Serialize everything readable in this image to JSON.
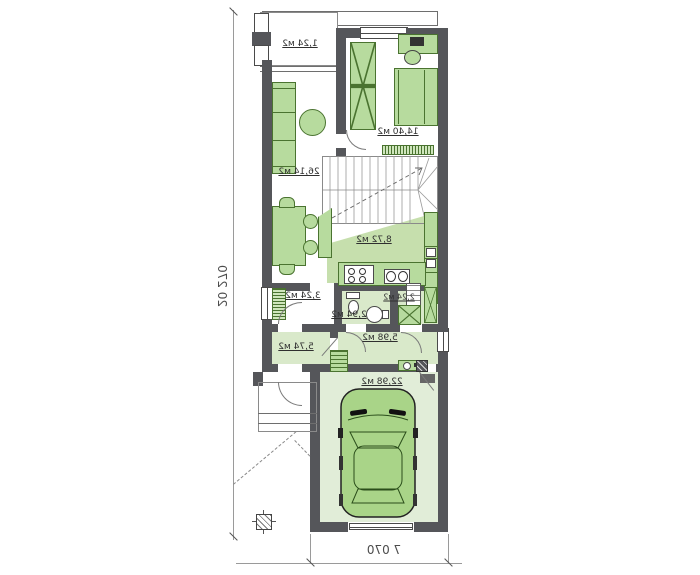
{
  "dimensions": {
    "plot_depth": "20 270",
    "house_width": "7 070"
  },
  "rooms": {
    "porch": "1,24 м2",
    "bedroom": "14,40 м2",
    "living_room": "26,14 м2",
    "kitchen": "8,72 м2",
    "pantry": "3,24 м2",
    "wc": "2,94 м2",
    "laundry": "2,24 м2",
    "hall": "5,98 м2",
    "vestibule": "5,74 м2",
    "garage": "22,98 м2"
  },
  "marks": {
    "kitchen_box": "s"
  },
  "colors": {
    "wall": "#55565a",
    "line": "#6e6e6e",
    "furniture": "#b7db9e",
    "furniture_border": "#4a7330",
    "floor_tint": "#d9e9ca",
    "kitchen_floor": "#c6dfad",
    "garage_floor": "#e1edd8",
    "car": "#a9d488",
    "text": "#2f2f2f",
    "dim_text": "#4c4c4c"
  }
}
